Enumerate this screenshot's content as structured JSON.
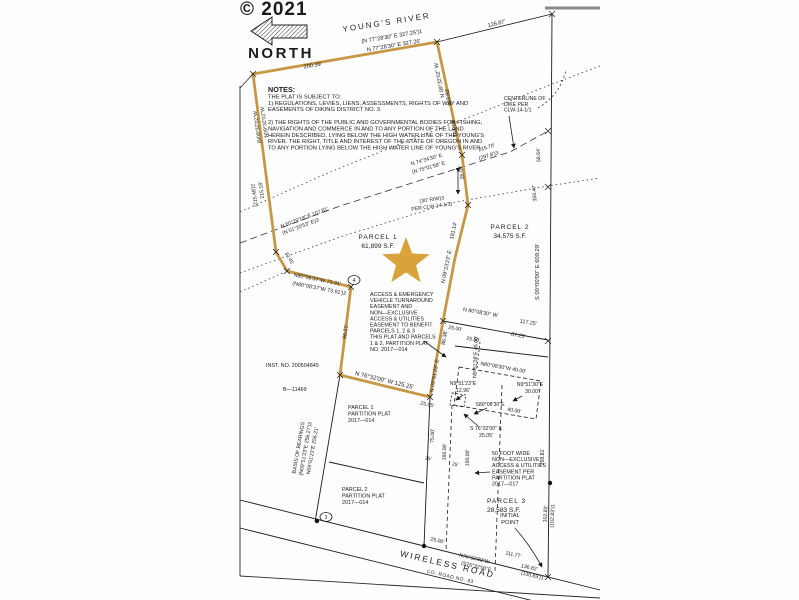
{
  "document": {
    "watermark": "© 2021",
    "north_label": "NORTH",
    "river_label": "YOUNG'S RIVER",
    "road_label": "WIRELESS ROAD",
    "road_number": "CO. ROAD NO. 83"
  },
  "colors": {
    "boundary_gold": "#c69845",
    "star_gold": "#d7a33a",
    "ink": "#1b1b1b",
    "watermark_gray": "#474747",
    "page_edge_gray": "#8a8a8a"
  },
  "parcels": [
    {
      "name": "PARCEL 1",
      "area": "61,899 S.F."
    },
    {
      "name": "PARCEL 2",
      "area": "34,575 S.F."
    },
    {
      "name": "PARCEL 3",
      "area": "28,583 S.F."
    }
  ],
  "text_blocks": [
    {
      "id": "notes-block",
      "x": 268,
      "y": 92,
      "lh": 6.4,
      "size": 5.8,
      "lines": [
        "NOTES:",
        "THE PLAT IS SUBJECT TO:",
        "1) REGULATIONS, LEVIES, LIENS, ASSESSMENTS, RIGHTS OF WAY AND",
        "EASEMENTS OF DIKING DISTRICT NO. 3.",
        " ",
        "2) THE RIGHTS OF THE PUBLIC AND GOVERNMENTAL BODIES FOR FISHING,",
        "NAVIGATION AND COMMERCE IN AND TO ANY PORTION OF THE LAND",
        "HEREIN DESCRIBED, LYING BELOW THE HIGH WATER LINE OF THE YOUNG'S",
        "RIVER. THE RIGHT, TITLE AND INTEREST OF THE STATE OF OREGON IN AND",
        "TO ANY PORTION LYING BELOW THE HIGH WATER LINE OF YOUNG'S RIVER."
      ],
      "first_bold": true,
      "first_size": 7.2
    },
    {
      "id": "centerline-dike-note",
      "x": 504,
      "y": 100,
      "lh": 5.8,
      "size": 5.2,
      "lines": [
        "CENTERLINE OF",
        "DIKE PER",
        "CLW-14-1/1"
      ]
    },
    {
      "id": "access-emergency-easement-note",
      "x": 370,
      "y": 296,
      "lh": 6.1,
      "size": 5.4,
      "lines": [
        "ACCESS & EMERGENCY",
        "VEHICLE TURNAROUND",
        "EASEMENT AND",
        "NON—EXCLUSIVE",
        "ACCESS & UTILITIES",
        "EASEMENT TO BENEFIT",
        "PARCELS 1, 2 & 3",
        "THIS PLAT AND PARCELS",
        "1 & 2, PARTITION PLAT",
        "NO. 2017—014"
      ]
    },
    {
      "id": "fifty-foot-easement-note",
      "x": 492,
      "y": 455,
      "lh": 6.1,
      "size": 5.4,
      "lines": [
        "50 FOOT WIDE",
        "NON—EXCLUSIVE",
        "ACCESS & UTILITIES",
        "EASEMENT PER",
        "PARTITION PLAT",
        "2017—017"
      ]
    },
    {
      "id": "parcel1-partition-note",
      "x": 348,
      "y": 409,
      "lh": 6.6,
      "size": 5.4,
      "lines": [
        "PARCEL 1",
        "PARTITION PLAT",
        "2017—014"
      ]
    },
    {
      "id": "parcel2-partition-note",
      "x": 342,
      "y": 491,
      "lh": 6.6,
      "size": 5.4,
      "lines": [
        "PARCEL 2",
        "PARTITION PLAT",
        "2017—014"
      ]
    }
  ],
  "svg_labels": [
    {
      "id": "watermark",
      "text": "© 2021",
      "x": 240,
      "y": 15,
      "size": 19,
      "bold": true,
      "fill": "#474747",
      "ls": 1
    },
    {
      "id": "north-label",
      "text": "NORTH",
      "x": 281,
      "y": 58,
      "size": 15,
      "bold": true,
      "anchor": "middle",
      "ls": 2.5
    },
    {
      "id": "river-label",
      "text": "YOUNG'S RIVER",
      "x": 387,
      "y": 25,
      "rot": -9,
      "size": 8,
      "anchor": "middle",
      "ls": 2
    },
    {
      "id": "bearing-top-record",
      "text": "(N 77°28'30\" E    327.25')1",
      "x": 392,
      "y": 38,
      "rot": -9.5,
      "size": 5.6,
      "anchor": "middle"
    },
    {
      "id": "bearing-top",
      "text": "N 77°28'30\" E    327.26'",
      "x": 394,
      "y": 47,
      "rot": -9.5,
      "size": 5.6,
      "anchor": "middle"
    },
    {
      "id": "dist-200-39",
      "text": "200.39'",
      "x": 313,
      "y": 67,
      "rot": -9.5,
      "size": 5.6,
      "anchor": "middle"
    },
    {
      "id": "dist-126-87",
      "text": "126.87'",
      "x": 497,
      "y": 25,
      "rot": -14,
      "size": 5.6,
      "anchor": "middle"
    },
    {
      "id": "bearing-ne-edge",
      "text": "N 09°32'02\" W",
      "x": 441,
      "y": 80,
      "rot": -101,
      "size": 5.4,
      "anchor": "middle"
    },
    {
      "id": "dist-123-83",
      "text": "123.83'",
      "x": 450,
      "y": 97,
      "rot": -101,
      "size": 5.4,
      "anchor": "middle"
    },
    {
      "id": "dist-161-13",
      "text": "161.13'",
      "x": 456,
      "y": 128,
      "rot": -101,
      "size": 5.4,
      "anchor": "middle"
    },
    {
      "id": "dist-26-04",
      "text": "26.04'",
      "x": 463,
      "y": 172,
      "rot": -101,
      "size": 5.4,
      "anchor": "middle"
    },
    {
      "id": "dist-215-70",
      "text": "215.70'",
      "x": 487,
      "y": 149,
      "rot": -17,
      "size": 5.2,
      "anchor": "middle"
    },
    {
      "id": "dist-297-8-record",
      "text": "(297.8')3",
      "x": 489,
      "y": 157,
      "rot": -17,
      "size": 5.2,
      "anchor": "middle"
    },
    {
      "id": "bearing-dike",
      "text": "N 74°34'30\" E",
      "x": 427,
      "y": 161,
      "rot": -16,
      "size": 5.2,
      "anchor": "middle"
    },
    {
      "id": "bearing-dike-record",
      "text": "(N 75°01'58\" E",
      "x": 429,
      "y": 169,
      "rot": -16,
      "size": 5.2,
      "anchor": "middle"
    },
    {
      "id": "dist-58-64",
      "text": "58.64'",
      "x": 540,
      "y": 155,
      "rot": -93,
      "size": 5.2,
      "anchor": "middle"
    },
    {
      "id": "dist-350-47",
      "text": "350.47'",
      "x": 536,
      "y": 193,
      "rot": -93,
      "size": 5.2,
      "anchor": "middle"
    },
    {
      "id": "rw-30-note",
      "text": "(30' R/W)3",
      "x": 432,
      "y": 201,
      "rot": -8,
      "size": 5.2,
      "anchor": "middle"
    },
    {
      "id": "rw-30-ref",
      "text": "PER CLW-14-1/1)",
      "x": 432,
      "y": 208,
      "rot": -8,
      "size": 5.2,
      "anchor": "middle"
    },
    {
      "id": "bearing-50-29",
      "text": "N 50°29'19\" E    107.81'",
      "x": 305,
      "y": 219,
      "rot": -21,
      "size": 5.2,
      "anchor": "middle"
    },
    {
      "id": "bearing-50-29-record",
      "text": "(N 51°20'53\" E)3",
      "x": 301,
      "y": 228,
      "rot": -21,
      "size": 5.2,
      "anchor": "middle"
    },
    {
      "id": "bearing-w-edge",
      "text": "N09°32'02\"W",
      "x": 266,
      "y": 122,
      "rot": -98,
      "size": 5.2,
      "anchor": "middle"
    },
    {
      "id": "bearing-w-edge-record",
      "text": "(N09°32'02\"W",
      "x": 259,
      "y": 127,
      "rot": -98,
      "size": 5.2,
      "anchor": "middle"
    },
    {
      "id": "dist-215-18",
      "text": "215.18'",
      "x": 263,
      "y": 190,
      "rot": -98,
      "size": 5.2,
      "anchor": "middle"
    },
    {
      "id": "dist-215-48-record",
      "text": "(215.48')2",
      "x": 256,
      "y": 195,
      "rot": -98,
      "size": 5.2,
      "anchor": "middle"
    },
    {
      "id": "dist-32-45",
      "text": "32.45'",
      "x": 288,
      "y": 259,
      "rot": 60,
      "size": 5,
      "anchor": "middle"
    },
    {
      "id": "parcel1-name",
      "text": "PARCEL 1",
      "x": 378,
      "y": 239,
      "size": 6.6,
      "anchor": "middle",
      "ls": 1
    },
    {
      "id": "parcel1-area",
      "text": "61,899 S.F.",
      "x": 378,
      "y": 248,
      "size": 6.6,
      "anchor": "middle"
    },
    {
      "id": "parcel2-name",
      "text": "PARCEL 2",
      "x": 510,
      "y": 229,
      "size": 6.6,
      "anchor": "middle",
      "ls": 1
    },
    {
      "id": "parcel2-area",
      "text": "34,575 S.F.",
      "x": 510,
      "y": 238,
      "size": 6.6,
      "anchor": "middle"
    },
    {
      "id": "parcel3-name",
      "text": "PARCEL 3",
      "x": 487,
      "y": 503,
      "size": 6.6,
      "ls": 1
    },
    {
      "id": "parcel3-area",
      "text": "28,583 S.F.",
      "x": 487,
      "y": 512,
      "size": 6.6
    },
    {
      "id": "bearing-80-08-37",
      "text": "N80°08'37\"W  73.91'",
      "x": 317,
      "y": 281,
      "rot": 11,
      "size": 5.4,
      "anchor": "middle"
    },
    {
      "id": "bearing-80-08-37-record",
      "text": "(N80°08'37\"W   73.91')2",
      "x": 319,
      "y": 290,
      "rot": 11,
      "size": 5.4,
      "anchor": "middle"
    },
    {
      "id": "dist-96-21",
      "text": "96.21'",
      "x": 347,
      "y": 332,
      "rot": -83,
      "size": 5.4,
      "anchor": "middle"
    },
    {
      "id": "inst-no",
      "text": "INST. NO. 200504845",
      "x": 266,
      "y": 367,
      "size": 5.4
    },
    {
      "id": "b-11469",
      "text": "B—11469",
      "x": 283,
      "y": 391,
      "size": 5.4
    },
    {
      "id": "dist-181-14",
      "text": "181.14'",
      "x": 455,
      "y": 231,
      "rot": -78,
      "size": 5.4,
      "anchor": "middle"
    },
    {
      "id": "bearing-09-23-23",
      "text": "N 09°23'23\" E",
      "x": 448,
      "y": 267,
      "rot": -78,
      "size": 5.4,
      "anchor": "middle"
    },
    {
      "id": "dist-86-38",
      "text": "86.38'",
      "x": 446,
      "y": 338,
      "rot": -80,
      "size": 5.4,
      "anchor": "middle"
    },
    {
      "id": "bearing-09-51-23-gold",
      "text": "N 09°51'23\" E",
      "x": 436,
      "y": 376,
      "rot": -80,
      "size": 5.4,
      "anchor": "middle"
    },
    {
      "id": "bearing-76-32-gold",
      "text": "N 76°32'00\" W   125.25'",
      "x": 384,
      "y": 382,
      "rot": 13.5,
      "size": 6,
      "anchor": "middle"
    },
    {
      "id": "basis-of-bearings",
      "text": "BASIS OF BEARINGS",
      "x": 300,
      "y": 448,
      "rot": -80,
      "size": 5.2,
      "anchor": "middle"
    },
    {
      "id": "basis-record",
      "text": "(N09°51'23\"E   256.27')3",
      "x": 307,
      "y": 449,
      "rot": -80,
      "size": 5.2,
      "anchor": "middle"
    },
    {
      "id": "basis-measured",
      "text": "N09°51'23\"E   256.21'",
      "x": 314,
      "y": 451,
      "rot": -80,
      "size": 5.2,
      "anchor": "middle"
    },
    {
      "id": "bearing-80-08-30",
      "text": "N 80°08'30\" W",
      "x": 480,
      "y": 314,
      "rot": 10,
      "size": 5.4,
      "anchor": "middle"
    },
    {
      "id": "dist-117-25",
      "text": "117.25'",
      "x": 528,
      "y": 324,
      "rot": 10,
      "size": 5.4,
      "anchor": "middle"
    },
    {
      "id": "dist-25-00-a",
      "text": "25.00'",
      "x": 455,
      "y": 330,
      "rot": 10,
      "size": 5.2,
      "anchor": "middle"
    },
    {
      "id": "dist-25-00-b",
      "text": "25.00'",
      "x": 473,
      "y": 341,
      "rot": 10,
      "size": 5.2,
      "anchor": "middle"
    },
    {
      "id": "dist-67-25",
      "text": "67.25'",
      "x": 518,
      "y": 337,
      "rot": 10,
      "size": 5.4,
      "anchor": "middle"
    },
    {
      "id": "bearing-45-00",
      "text": "N9°51'28\"E  45.00'",
      "x": 477,
      "y": 357,
      "rot": -88,
      "size": 5.2,
      "anchor": "middle"
    },
    {
      "id": "bearing-40-00-n",
      "text": "N80°08'30\"W  40.00'",
      "x": 503,
      "y": 369,
      "rot": 10,
      "size": 5.2,
      "anchor": "middle"
    },
    {
      "id": "bearing-30-00-a",
      "text": "N9°51'30\"E",
      "x": 530,
      "y": 386,
      "size": 5.2,
      "anchor": "middle"
    },
    {
      "id": "bearing-30-00-b",
      "text": "30.00'",
      "x": 532,
      "y": 393,
      "size": 5.2,
      "anchor": "middle"
    },
    {
      "id": "bearing-12-96-a",
      "text": "N9°51'23\"E",
      "x": 463,
      "y": 385,
      "size": 5.2,
      "anchor": "middle"
    },
    {
      "id": "bearing-12-96-b",
      "text": "12.96'",
      "x": 463,
      "y": 392,
      "size": 5.2,
      "anchor": "middle"
    },
    {
      "id": "bearing-40-00-s",
      "text": "S80°08'30\"E",
      "x": 490,
      "y": 406,
      "size": 5.2,
      "anchor": "middle"
    },
    {
      "id": "dist-40-00-s",
      "text": "40.00'",
      "x": 514,
      "y": 412,
      "rot": 10,
      "size": 5.2,
      "anchor": "middle"
    },
    {
      "id": "bearing-25-05-a",
      "text": "S 76°32'00\" E",
      "x": 486,
      "y": 430,
      "size": 5.2,
      "anchor": "middle"
    },
    {
      "id": "bearing-25-05-b",
      "text": "25.05'",
      "x": 486,
      "y": 437,
      "size": 5.2,
      "anchor": "middle"
    },
    {
      "id": "dist-25-05",
      "text": "25.05'",
      "x": 427,
      "y": 406,
      "rot": 12,
      "size": 5.2,
      "anchor": "middle"
    },
    {
      "id": "dist-75-00",
      "text": "75.00'",
      "x": 434,
      "y": 436,
      "rot": -88,
      "size": 5.2,
      "anchor": "middle"
    },
    {
      "id": "dist-160-00-a",
      "text": "160.00'",
      "x": 446,
      "y": 452,
      "rot": -88,
      "size": 5.2,
      "anchor": "middle"
    },
    {
      "id": "dist-160-00-b",
      "text": "160.00'",
      "x": 469,
      "y": 458,
      "rot": -88,
      "size": 5.2,
      "anchor": "middle"
    },
    {
      "id": "dist-25-a",
      "text": "25'",
      "x": 428,
      "y": 460,
      "rot": 12,
      "size": 5,
      "anchor": "middle"
    },
    {
      "id": "dist-25-b",
      "text": "25'",
      "x": 455,
      "y": 466,
      "rot": 12,
      "size": 5,
      "anchor": "middle"
    },
    {
      "id": "bearing-s00",
      "text": "S 00°00'00\" E      609.29'",
      "x": 539,
      "y": 272,
      "rot": -90,
      "size": 5.8,
      "anchor": "middle"
    },
    {
      "id": "dist-258-81",
      "text": "258.81'",
      "x": 544,
      "y": 457,
      "rot": -90,
      "size": 5.2,
      "anchor": "middle"
    },
    {
      "id": "dist-102-83",
      "text": "102.83'",
      "x": 547,
      "y": 514,
      "rot": -87,
      "size": 5.2,
      "anchor": "middle"
    },
    {
      "id": "dist-102-83-record",
      "text": "(102.83')1",
      "x": 554,
      "y": 516,
      "rot": -87,
      "size": 5.2,
      "anchor": "middle"
    },
    {
      "id": "initial-point-a",
      "text": "INITIAL",
      "x": 510,
      "y": 517,
      "size": 5.8,
      "anchor": "middle"
    },
    {
      "id": "initial-point-b",
      "text": "POINT",
      "x": 510,
      "y": 524,
      "size": 5.8,
      "anchor": "middle"
    },
    {
      "id": "bearing-road",
      "text": "N76°32'00\"W",
      "x": 474,
      "y": 560,
      "rot": 13,
      "size": 5.2,
      "anchor": "middle"
    },
    {
      "id": "bearing-road-record",
      "text": "(S76°32'00\"E",
      "x": 476,
      "y": 568,
      "rot": 13,
      "size": 5.2,
      "anchor": "middle"
    },
    {
      "id": "dist-111-77",
      "text": "111.77'",
      "x": 513,
      "y": 556,
      "rot": 13,
      "size": 5.2,
      "anchor": "middle"
    },
    {
      "id": "dist-136-82",
      "text": "136.82'",
      "x": 529,
      "y": 569,
      "rot": 13,
      "size": 5.2,
      "anchor": "middle"
    },
    {
      "id": "dist-136-83-record",
      "text": "(136.83')1",
      "x": 532,
      "y": 577,
      "rot": 13,
      "size": 5.2,
      "anchor": "middle"
    },
    {
      "id": "dist-25-00-road",
      "text": "25.00'",
      "x": 437,
      "y": 542,
      "rot": 13,
      "size": 5.2,
      "anchor": "middle"
    },
    {
      "id": "road-name",
      "text": "WIRELESS ROAD",
      "x": 447,
      "y": 567,
      "rot": 13,
      "size": 8.5,
      "anchor": "middle",
      "ls": 2
    },
    {
      "id": "road-number",
      "text": "CO. ROAD NO. 83",
      "x": 450,
      "y": 578,
      "rot": 13,
      "size": 4.8,
      "anchor": "middle",
      "ls": 0.5
    }
  ],
  "circled_points": [
    {
      "id": "ref-point-4",
      "n": "4",
      "x": 354,
      "y": 280
    },
    {
      "id": "ref-point-3",
      "n": "3",
      "x": 326,
      "y": 517
    }
  ]
}
